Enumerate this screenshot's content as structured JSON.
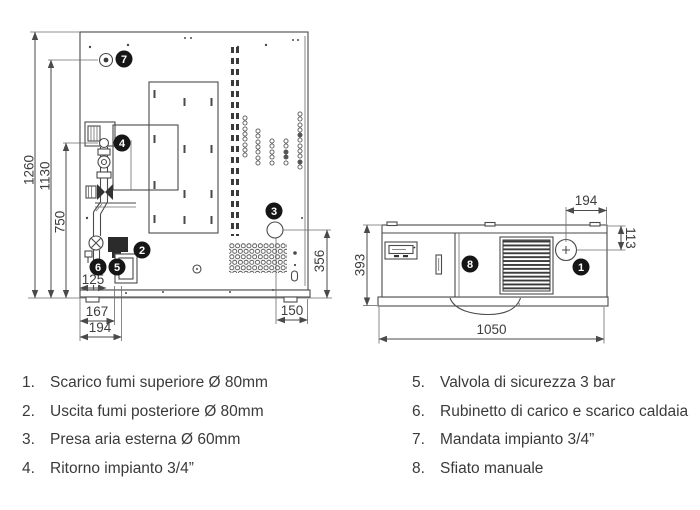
{
  "colors": {
    "line": "#4a4a4a",
    "text": "#3a3a3a",
    "badge": "#161616",
    "badge_text": "#ffffff"
  },
  "rear_view": {
    "dims": {
      "total_height": "1260",
      "supply_height": "1130",
      "return_height": "750",
      "drain_offset": "125",
      "flue_offset_x": "167",
      "pipe_offset_x": "194",
      "air_intake_height": "356",
      "air_intake_offset_x": "150"
    },
    "callouts": {
      "supply": "7",
      "return": "4",
      "rear_flue": "2",
      "drain": "6",
      "safety_valve": "5",
      "air_intake": "3"
    }
  },
  "top_view": {
    "dims": {
      "width": "1050",
      "depth": "393",
      "flue_offset_right": "194",
      "flue_offset_front": "113"
    },
    "callouts": {
      "top_flue": "1",
      "manual_vent": "8"
    }
  },
  "legend": {
    "left": [
      {
        "num": "1.",
        "label": "Scarico fumi superiore Ø 80mm"
      },
      {
        "num": "2.",
        "label": "Uscita fumi posteriore Ø 80mm"
      },
      {
        "num": "3.",
        "label": "Presa aria esterna Ø 60mm"
      },
      {
        "num": "4.",
        "label": "Ritorno impianto 3/4”"
      }
    ],
    "right": [
      {
        "num": "5.",
        "label": "Valvola di sicurezza 3 bar"
      },
      {
        "num": "6.",
        "label": "Rubinetto di carico e scarico caldaia"
      },
      {
        "num": "7.",
        "label": "Mandata impianto 3/4”"
      },
      {
        "num": "8.",
        "label": "Sfiato manuale"
      }
    ]
  }
}
